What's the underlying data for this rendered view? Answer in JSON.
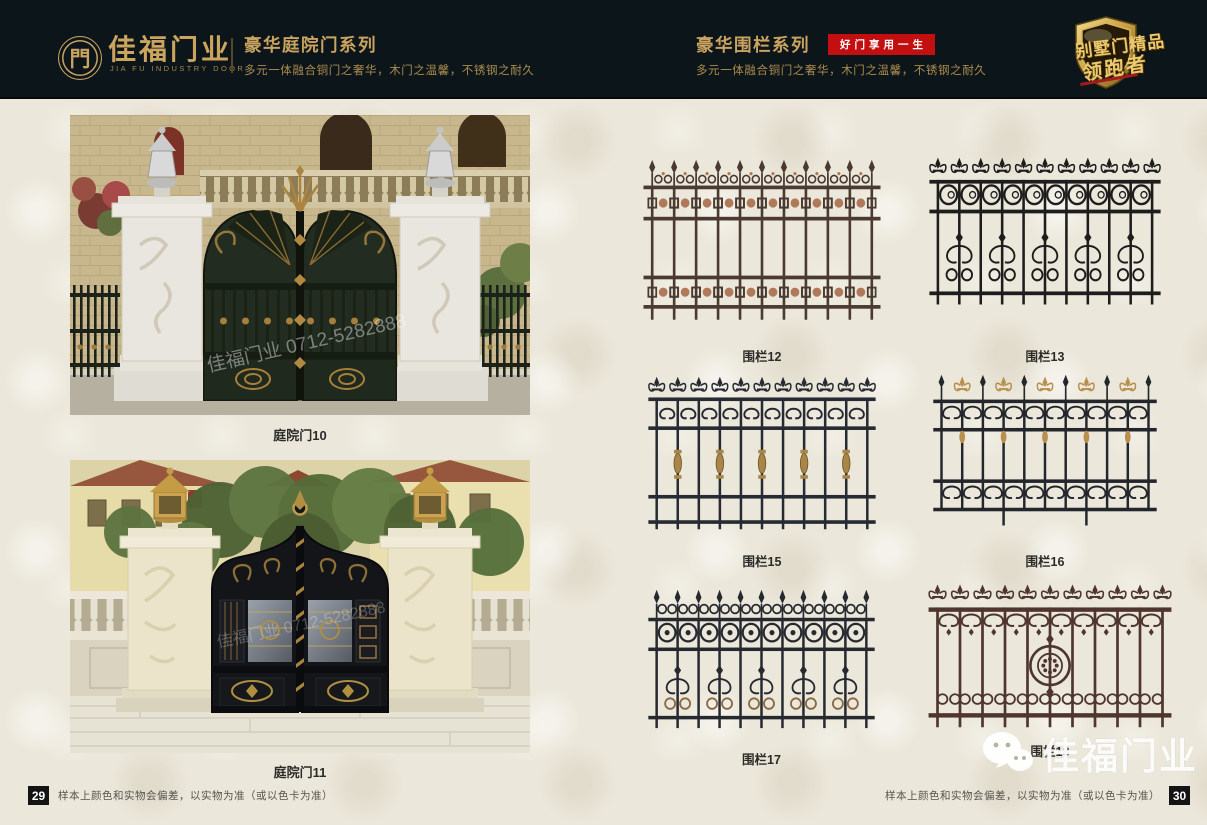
{
  "header": {
    "background": "#0c151a",
    "gold": "#c9a35f",
    "logo": {
      "symbol": "門",
      "company": "佳福门业",
      "company_en": "JIA FU INDUSTRY DOOR"
    },
    "series_left": {
      "title": "豪华庭院门系列",
      "subtitle": "多元一体融合铜门之奢华，木门之温馨，不锈钢之耐久"
    },
    "series_right": {
      "title": "豪华围栏系列",
      "badge": "好门享用一生",
      "badge_color": "#c30f0f",
      "subtitle": "多元一体融合铜门之奢华，木门之温馨，不锈钢之耐久"
    },
    "award_badge": {
      "line1": "别墅门精品",
      "line2": "领跑者"
    }
  },
  "left_page": {
    "products": [
      {
        "label": "庭院门10",
        "type": "courtyard-gate-photo"
      },
      {
        "label": "庭院门11",
        "type": "courtyard-gate-photo"
      }
    ],
    "photo_watermark": "佳福门业 0712-5282888",
    "footer": {
      "page_number": "29",
      "disclaimer": "样本上颜色和实物会偏差，以实物为准（或以色卡为准）"
    }
  },
  "right_page": {
    "products": [
      {
        "label": "围栏12",
        "style": "geo",
        "color": "#4a3a30",
        "accent": "#b07a5a"
      },
      {
        "label": "围栏13",
        "style": "circles",
        "color": "#1d1d1d",
        "accent": "#1d1d1d"
      },
      {
        "label": "围栏15",
        "style": "spindle",
        "color": "#262b33",
        "accent": "#a98648"
      },
      {
        "label": "围栏16",
        "style": "altgold",
        "color": "#23262c",
        "accent": "#b98f4e"
      },
      {
        "label": "围栏17",
        "style": "circscroll",
        "color": "#262a30",
        "accent": "#8a6a45"
      },
      {
        "label": "围栏18",
        "style": "medallion",
        "color": "#4e352e",
        "accent": "#6b463a"
      }
    ],
    "footer": {
      "page_number": "30",
      "disclaimer": "样本上颜色和实物会偏差，以实物为准（或以色卡为准）"
    }
  },
  "watermark_logo": {
    "text": "佳福门业",
    "icon": "wechat-icon"
  }
}
